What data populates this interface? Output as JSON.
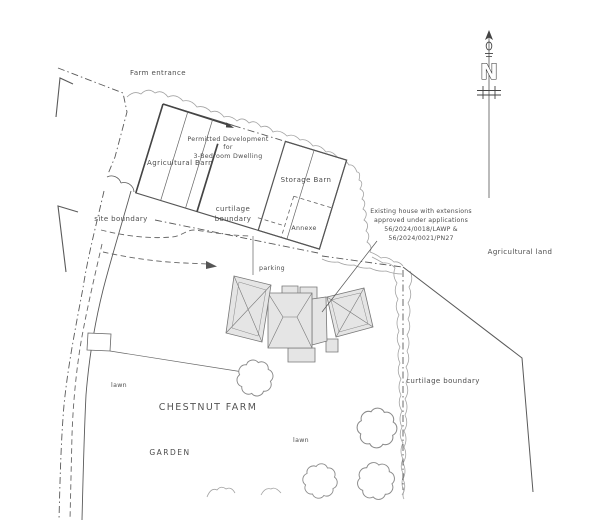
{
  "plan": {
    "farm_entrance": "Farm entrance",
    "permitted_line1": "Permitted Development",
    "permitted_line2": "for",
    "permitted_line3": "3-Bedroom Dwelling",
    "agricultural_barn": "Agricultural Barn",
    "storage_barn": "Storage Barn",
    "annexe": "Annexe",
    "curtilage_word1": "curtilage",
    "curtilage_word2": "boundary",
    "site_boundary": "site boundary",
    "existing_line1": "Existing house with extensions",
    "existing_line2": "approved under applications",
    "existing_line3": "56/2024/0018/LAWP &",
    "existing_line4": "56/2024/0021/PN27",
    "agricultural_land": "Agricultural land",
    "parking": "parking",
    "curtilage_right": "curtilage boundary",
    "lawn_left": "lawn",
    "lawn_right": "lawn",
    "farm_name": "CHESTNUT FARM",
    "garden": "GARDEN"
  },
  "compass": {
    "north_letter": "N"
  },
  "colors": {
    "linework": "#5a5a5a",
    "vegetation": "#a3a3a3",
    "house_fill": "#e5e5e5",
    "text": "#4d4d4d"
  }
}
